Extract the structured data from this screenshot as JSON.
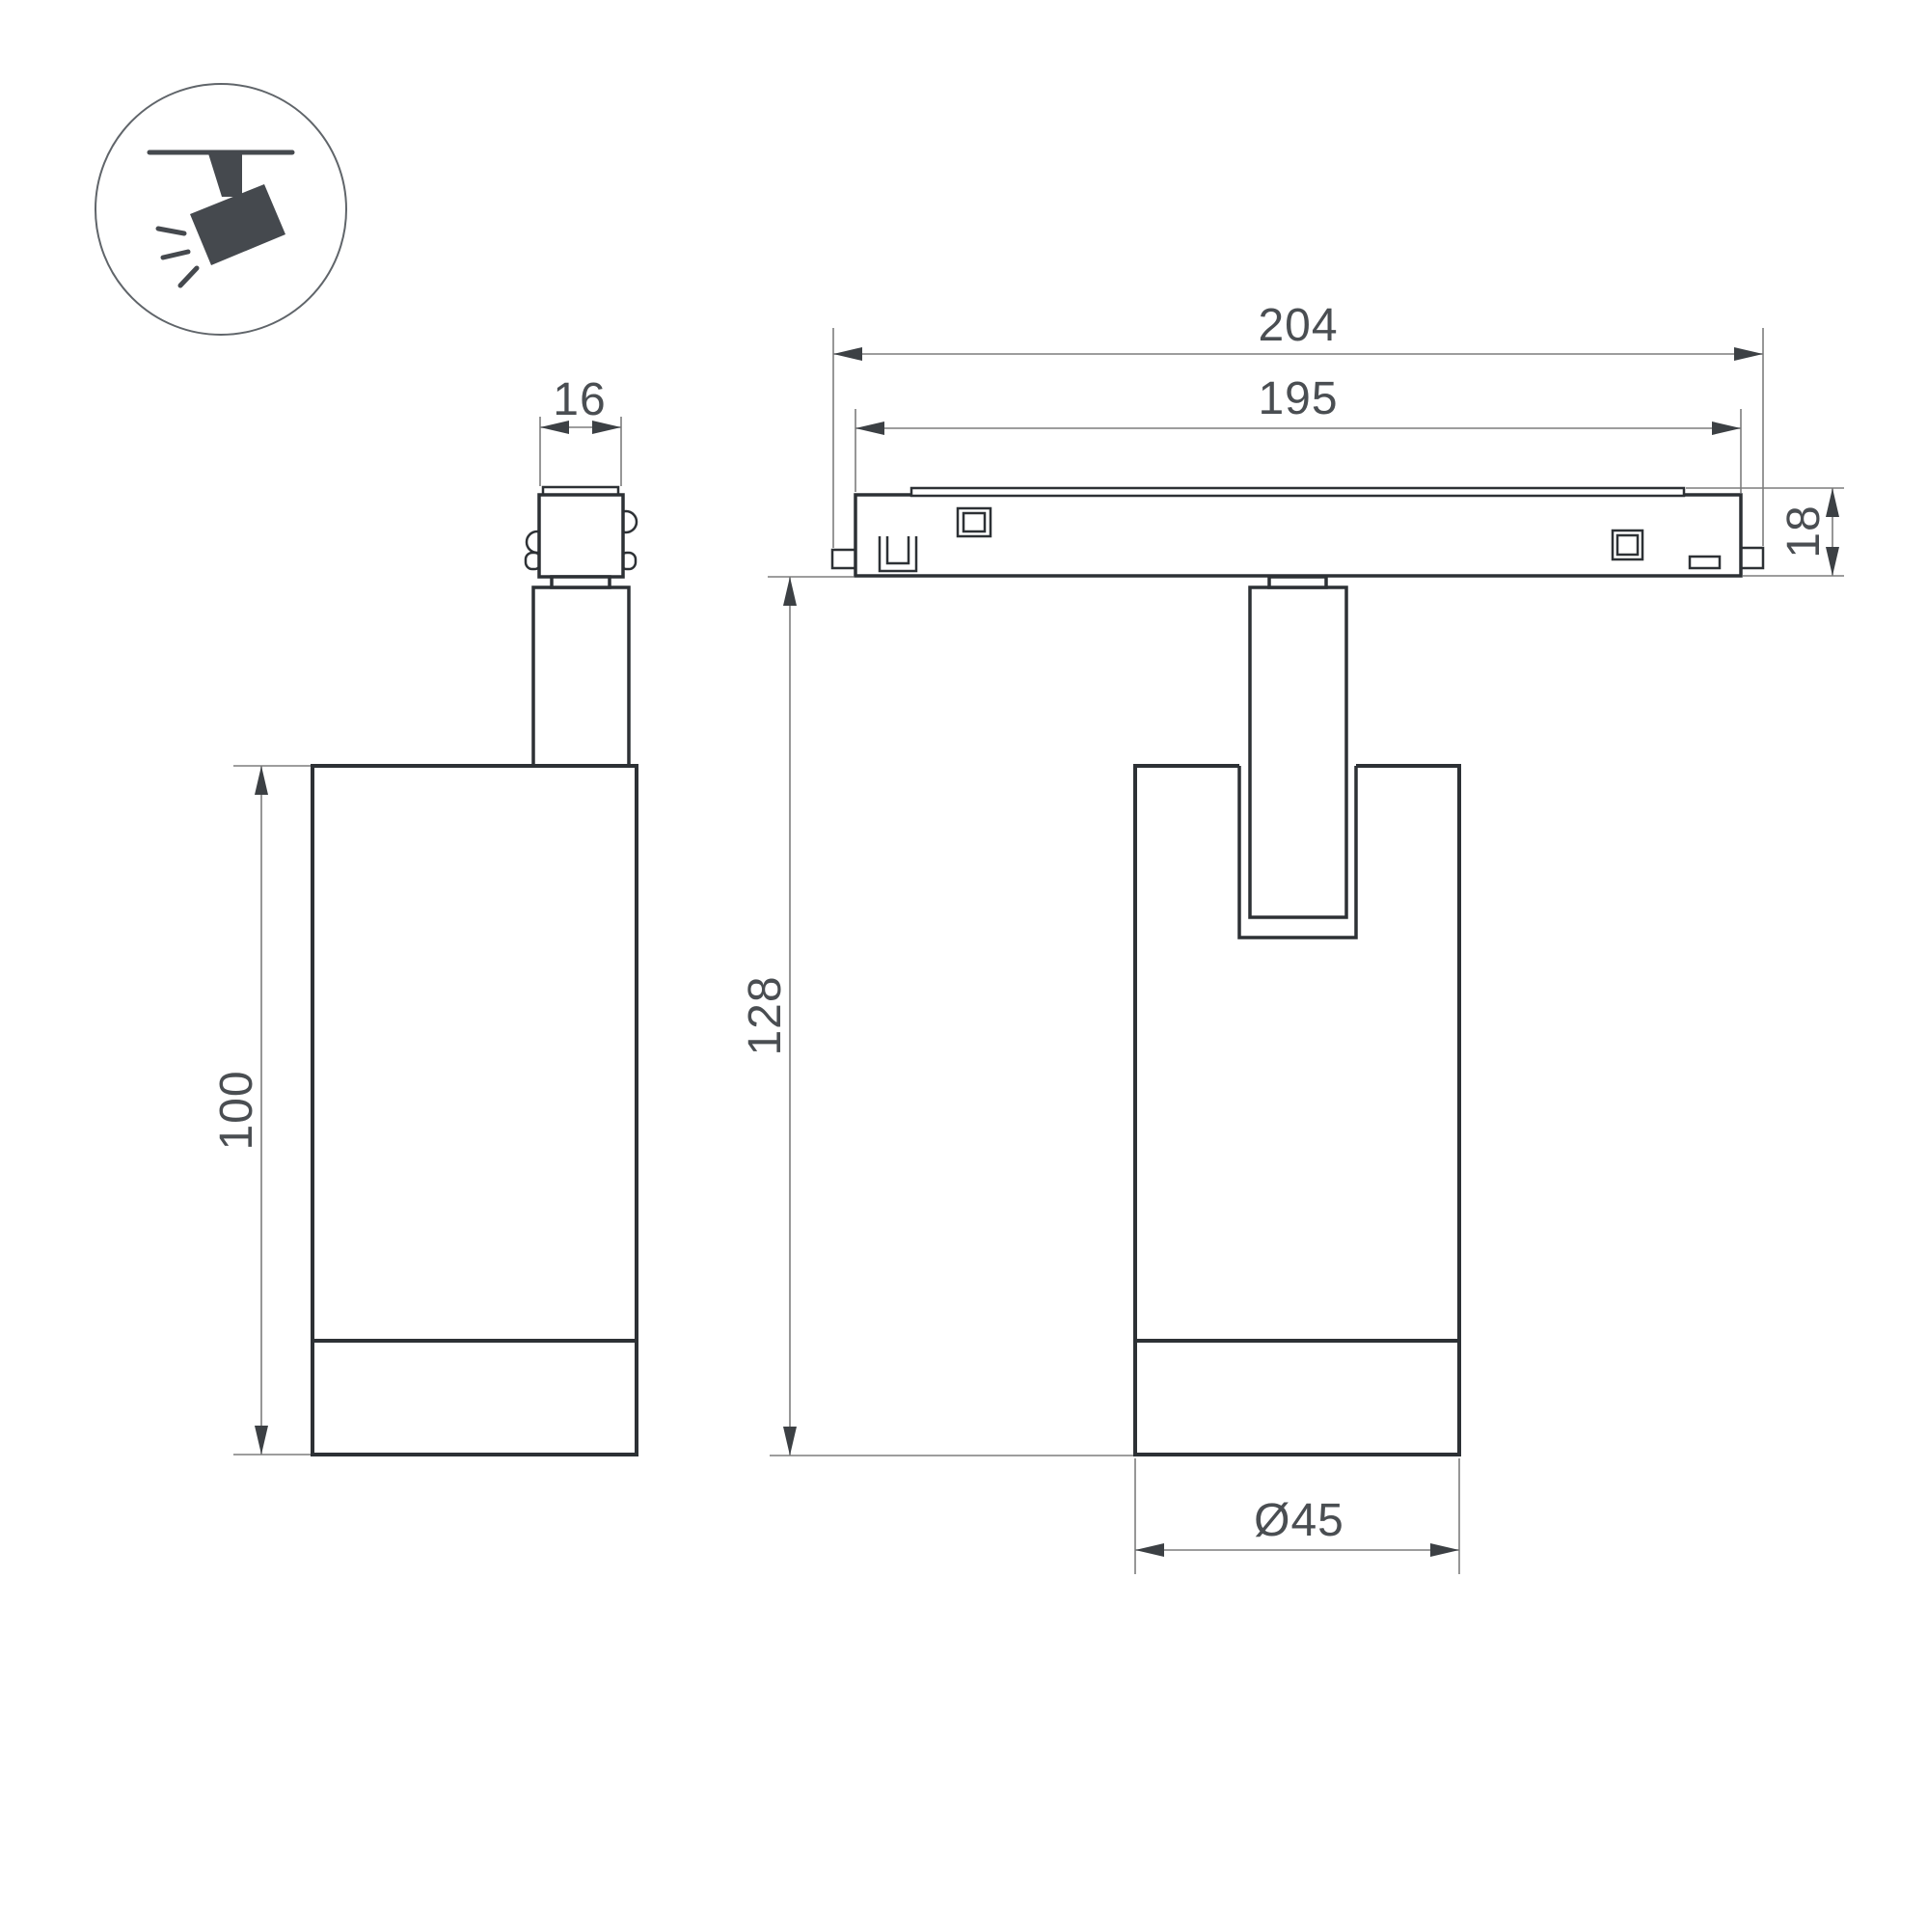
{
  "drawing": {
    "title": "Ceiling track spotlight — dimensional technical drawing",
    "icon": {
      "name": "ceiling-track-spotlight-icon"
    },
    "side_view": {
      "connector_width": "16",
      "body_height": "100"
    },
    "front_view": {
      "track_length": "204",
      "track_inner_length": "195",
      "track_height": "18",
      "overall_height": "128",
      "body_diameter": "Ø45"
    }
  },
  "colors": {
    "background": "#ffffff",
    "outline": "#2d3135",
    "dimension_lines": "#7d7d7d",
    "dimension_text": "#4a4e52",
    "icon_fill": "#45494e"
  }
}
